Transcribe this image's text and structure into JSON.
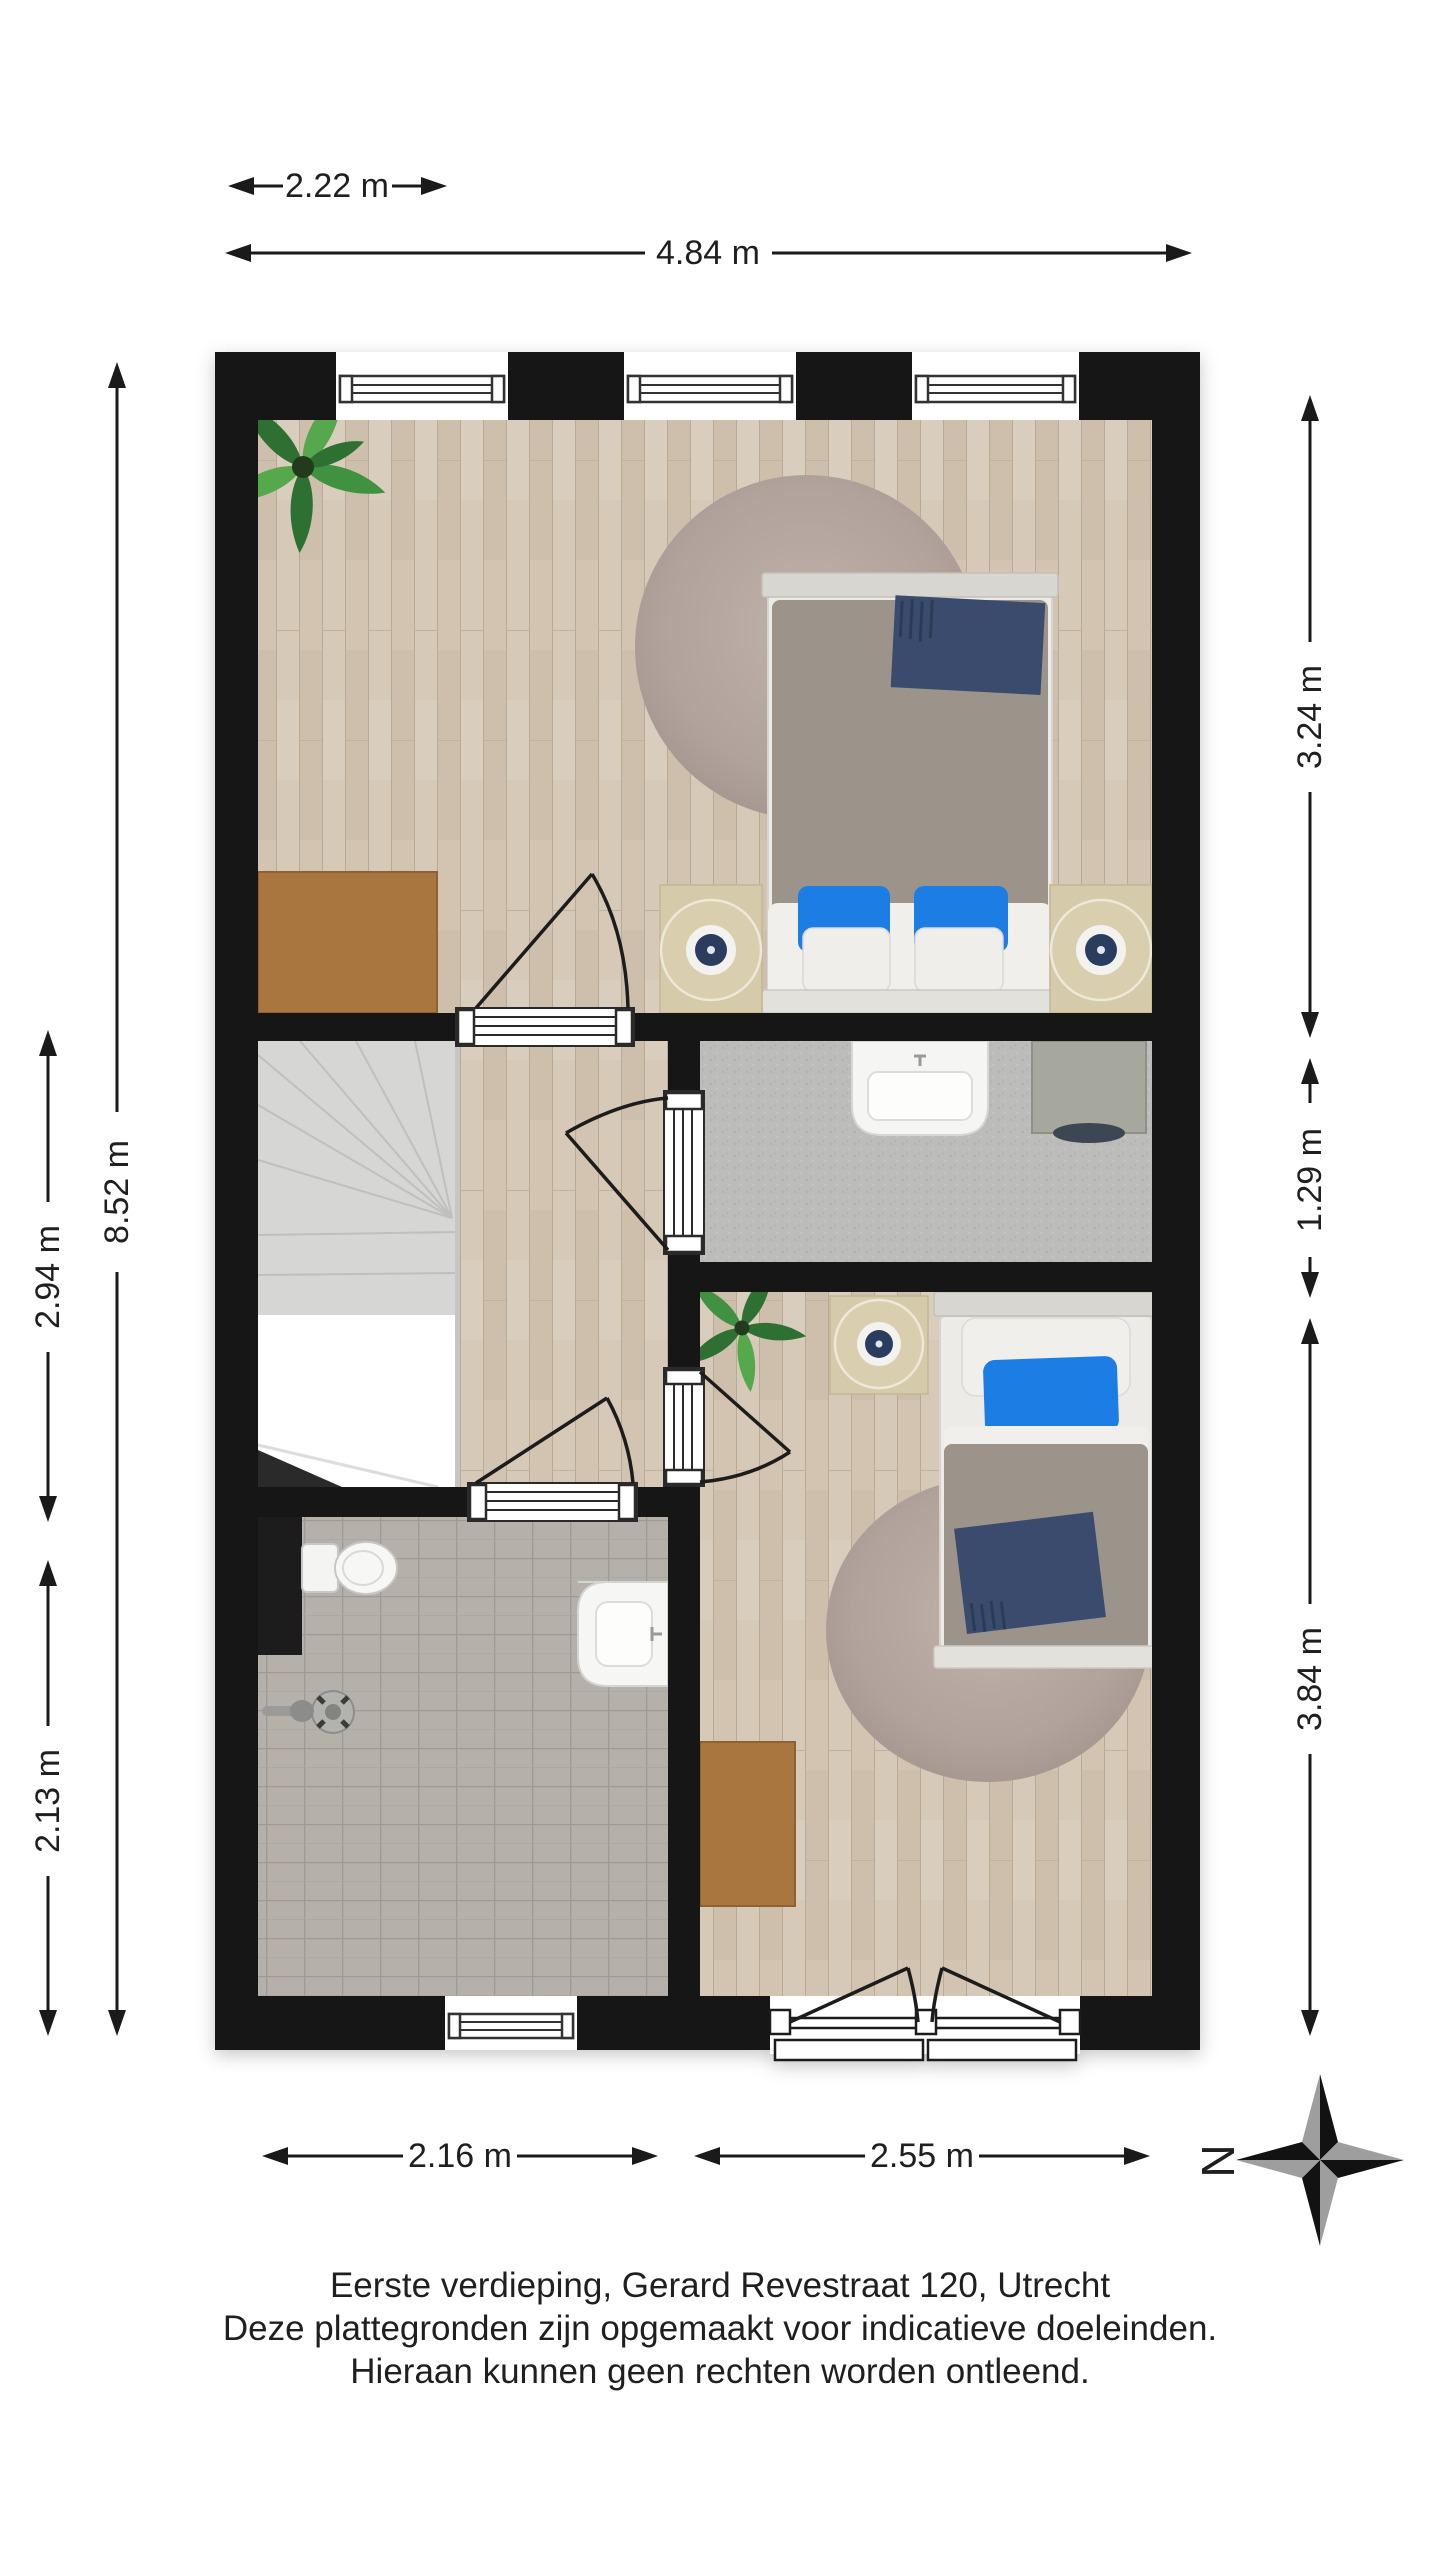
{
  "page": {
    "background": "#ffffff"
  },
  "dimensions": {
    "top": [
      {
        "label": "2.22 m"
      },
      {
        "label": "4.84 m"
      }
    ],
    "left": [
      {
        "label": "8.52 m"
      },
      {
        "label": "2.94 m"
      },
      {
        "label": "2.13 m"
      }
    ],
    "right": [
      {
        "label": "3.24 m"
      },
      {
        "label": "1.29 m"
      },
      {
        "label": "3.84 m"
      }
    ],
    "bottom": [
      {
        "label": "2.16 m"
      },
      {
        "label": "2.55 m"
      }
    ]
  },
  "compass": {
    "north_label": "N"
  },
  "caption": {
    "line1": "Eerste verdieping, Gerard Revestraat 120, Utrecht",
    "line2": "Deze plattegronden zijn opgemaakt voor indicatieve doeleinden.",
    "line3": "Hieraan kunnen geen rechten worden ontleend."
  },
  "icons": {
    "furniture": [
      "potted-plant",
      "round-rug",
      "double-bed",
      "single-bed",
      "nightstand-lamp",
      "desk",
      "staircase",
      "washbasin",
      "washing-machine",
      "toilet",
      "shower-drain",
      "window",
      "french-doors",
      "door-swing",
      "compass-rose"
    ]
  },
  "colors": {
    "wall": "#161616",
    "wood_light": "#d6c9b7",
    "wood_dark": "#cdbfab",
    "laundry_floor": "#bcbcba",
    "bathroom_tile": "#b5b0aa",
    "rug": "#b1a29b",
    "duvet_gray": "#9c948a",
    "pillow_blue": "#1d7de4",
    "throw_navy": "#3a4b6d",
    "nightstand_beige": "#d5caa9",
    "desk_brown": "#aa763f",
    "plant_green": "#3f9140",
    "stairs_gray": "#d6d6d4"
  }
}
